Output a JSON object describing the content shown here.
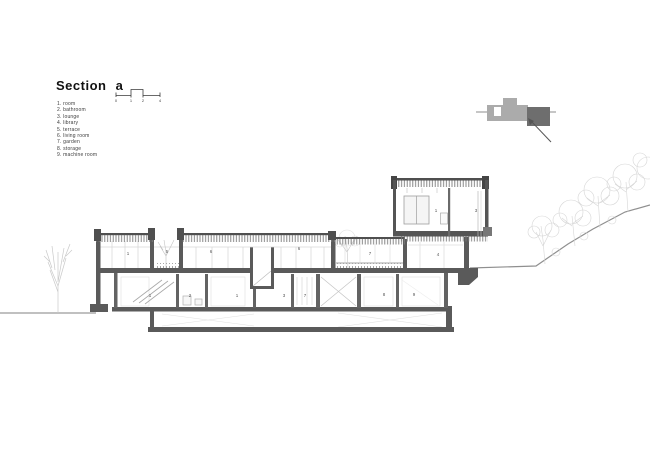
{
  "title_block": {
    "title": "Section a",
    "scale_ticks": [
      "0",
      "1",
      "2",
      "4"
    ]
  },
  "legend": {
    "items": [
      "1. room",
      "2. bathroom",
      "3. lounge",
      "4. library",
      "5. terrace",
      "6. living room",
      "7. garden",
      "8. storage",
      "9. machine room"
    ]
  },
  "room_labels": {
    "upper": [
      "1",
      "3"
    ],
    "main": [
      "1",
      "5",
      "6",
      "6",
      "7",
      "4"
    ],
    "basement": [
      "1",
      "2",
      "1",
      "3",
      "7",
      "8",
      "9"
    ]
  },
  "colors": {
    "wall_dark": "#5a5a5a",
    "roof_edge": "#4f4f4f",
    "light_line": "#d6d6d6",
    "tree": "#cccccc",
    "terrain": "#8f8f8f",
    "keyplan_light": "#ababab",
    "keyplan_dark": "#6e6e6e",
    "text": "#3c3c3c"
  }
}
